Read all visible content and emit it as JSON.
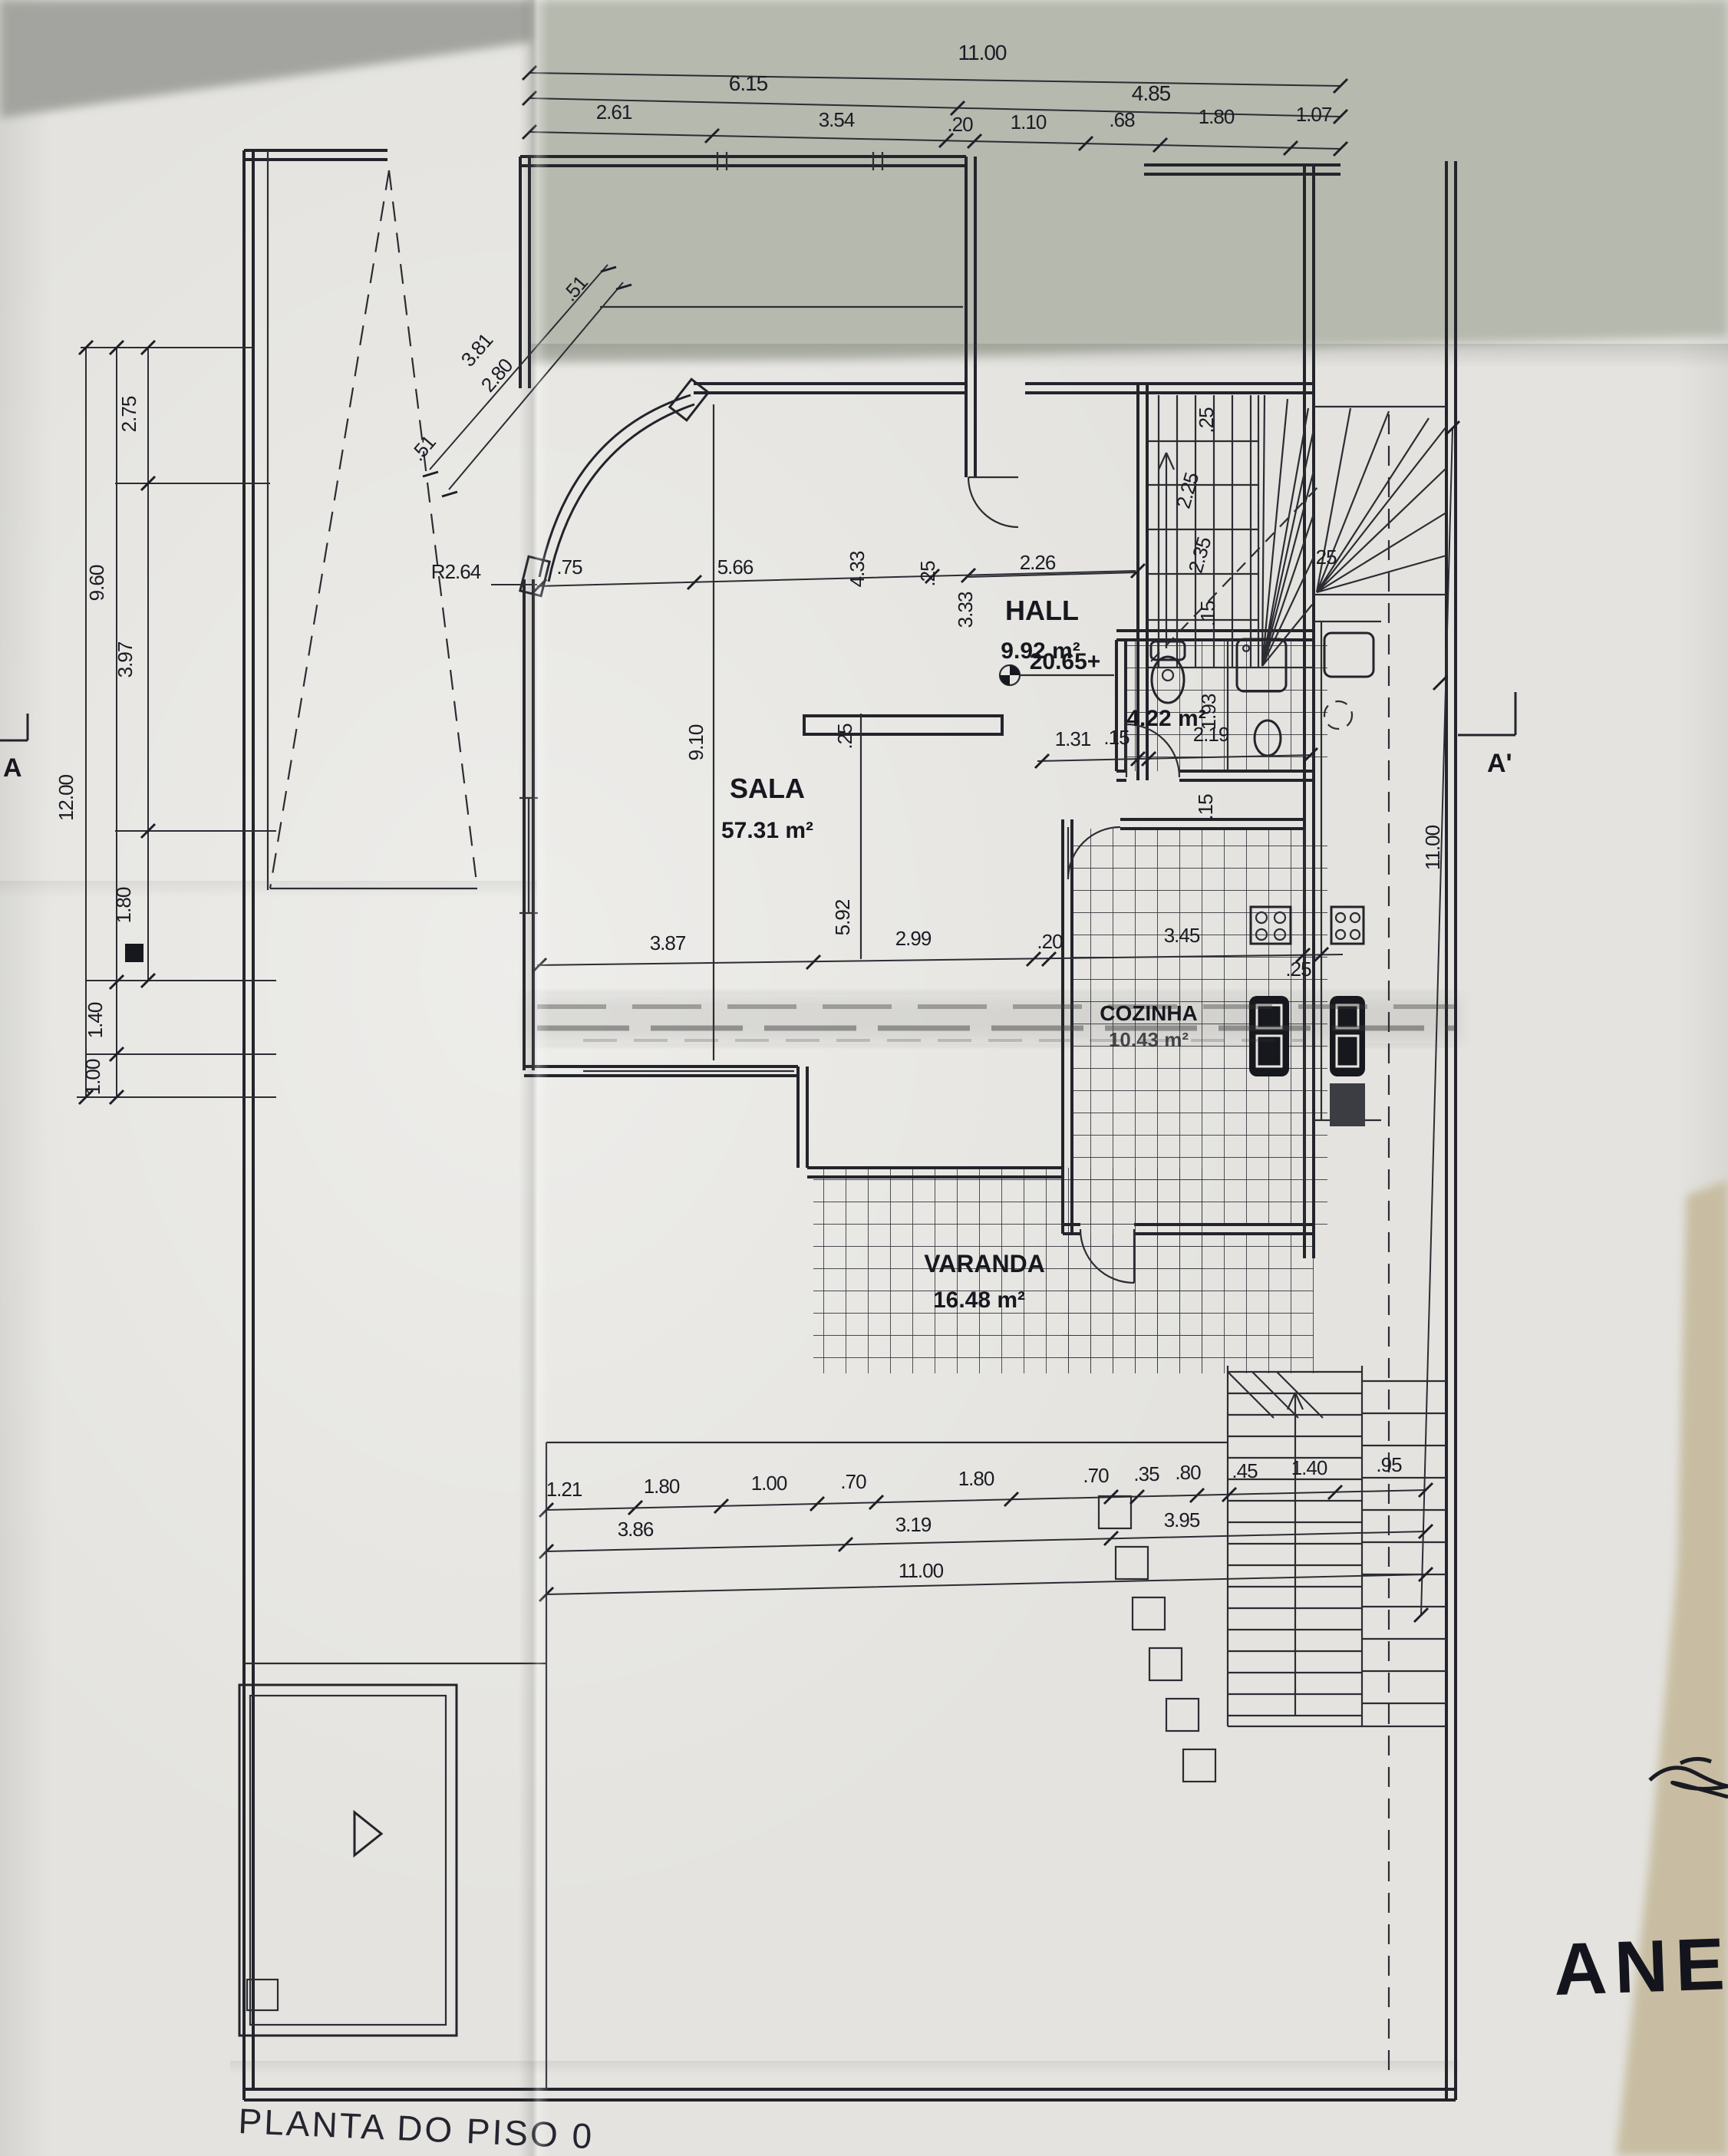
{
  "title": "PLANTA DO PISO 0",
  "handwriting": {
    "annex": "ANEXO"
  },
  "sections": {
    "a": "A",
    "a_prime": "A'"
  },
  "level_mark": "20.65+",
  "rooms": {
    "sala": {
      "name": "SALA",
      "area": "57.31 m²"
    },
    "hall": {
      "name": "HALL",
      "area": "9.92 m²"
    },
    "wc": {
      "area": "4.22 m²"
    },
    "cozinha": {
      "name": "COZINHA",
      "area": "10.43 m²"
    },
    "varanda": {
      "name": "VARANDA",
      "area": "16.48 m²"
    }
  },
  "dims": {
    "top1": "11.00",
    "top2": [
      "6.15",
      "4.85"
    ],
    "top3": [
      "2.61",
      "3.54",
      ".20",
      "1.10",
      ".68",
      "1.80",
      "1.07"
    ],
    "diag": [
      "3.81",
      "2.80",
      ".51",
      ".51"
    ],
    "left_outer": "12.00",
    "left_mid": [
      "9.60",
      "1.40",
      "1.00"
    ],
    "left_in": [
      "2.75",
      "3.97",
      "1.80"
    ],
    "curve_radius": "R2.64",
    "upper_row": [
      ".75",
      "5.66",
      "4.33",
      ".25",
      "2.26"
    ],
    "hall_h": "3.33",
    "sala_h": "9.10",
    "sala_in": [
      ".25",
      "5.92"
    ],
    "stair": [
      ".25",
      "2.25",
      "2.35",
      ".15"
    ],
    "wc_row": [
      "1.31",
      ".15",
      "2.19"
    ],
    "wc_v": "1.93",
    "kitchen_v": ".15",
    "right_wall": ".25",
    "mid_row": [
      "3.87",
      "2.99",
      ".20",
      "3.45",
      ".25"
    ],
    "right_v": "11.00",
    "bottom1": [
      "1.21",
      "1.80",
      "1.00",
      ".70",
      "1.80",
      ".70",
      ".35",
      ".80",
      ".45",
      "1.40",
      ".95"
    ],
    "bottom2": [
      "3.86",
      "3.19",
      "3.95"
    ],
    "bottom3": "11.00"
  },
  "colors": {
    "ink": "#23242b",
    "paper": "#e6e5e1",
    "shadow_gray": "#b6bab0",
    "table_beige": "#c8bda2"
  }
}
